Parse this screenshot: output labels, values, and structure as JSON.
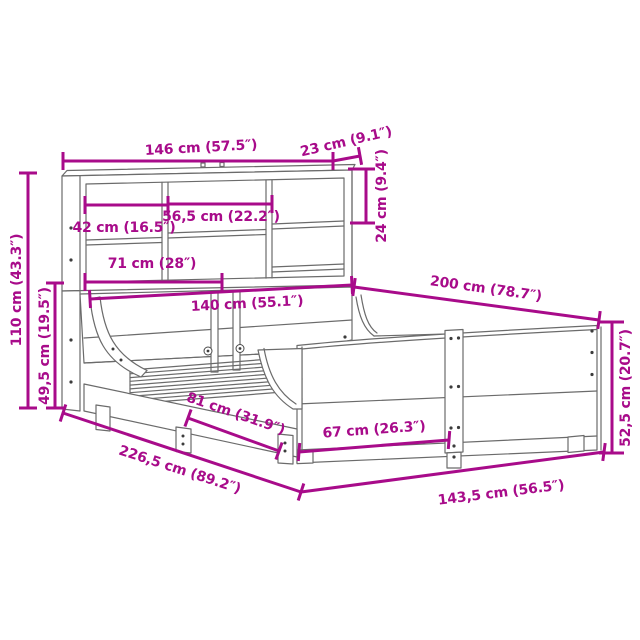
{
  "figure": {
    "subject": "bookcase-bed-frame-dimension-diagram"
  },
  "colors": {
    "dimension_accent": "#a80b8a",
    "linework": "#6b6b6b",
    "background": "#ffffff"
  },
  "dimensions": {
    "headboard_width": "146 cm (57.5″)",
    "headboard_depth": "23 cm (9.1″)",
    "shelf_opening_height": "24 cm (9.4″)",
    "left_compartment_width": "42 cm (16.5″)",
    "middle_compartment_width": "56,5 cm (22.2″)",
    "lower_shelf_width": "71 cm (28″)",
    "mattress_width": "140 cm (55.1″)",
    "mattress_length": "200 cm (78.7″)",
    "headboard_height": "110 cm (43.3″)",
    "headboard_lower_height": "49,5 cm (19.5″)",
    "rail_section_length": "81 cm (31.9″)",
    "footboard_section_length": "67 cm (26.3″)",
    "total_length": "226,5 cm (89.2″)",
    "total_width": "143,5 cm (56.5″)",
    "side_rail_height": "52,5 cm (20.7″)"
  }
}
